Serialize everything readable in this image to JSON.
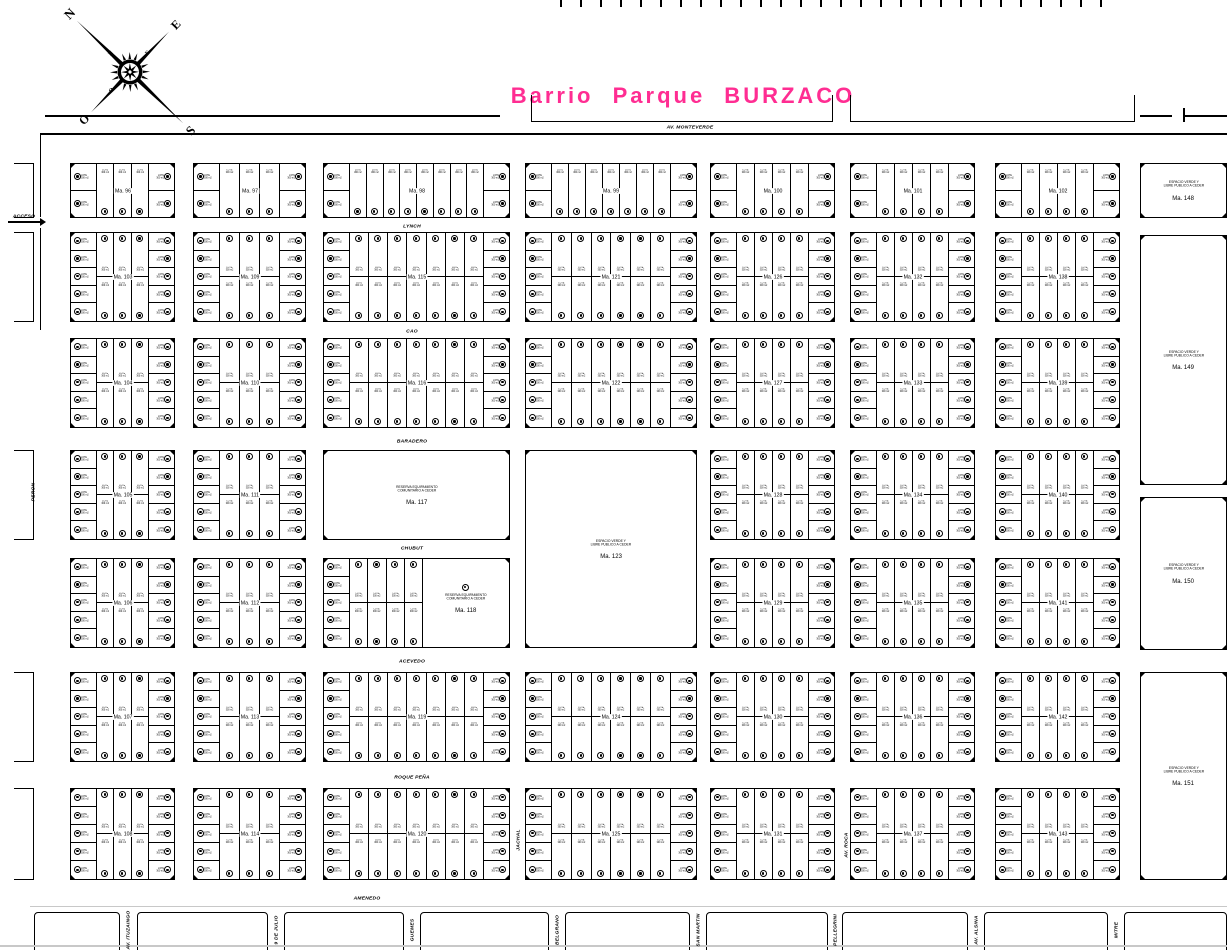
{
  "title": {
    "text": "Barrio Parque BURZACO",
    "color": "#ff2d92"
  },
  "compass": {
    "n": "N",
    "e": "E",
    "s": "S",
    "o": "O"
  },
  "access": {
    "label": "ACCESO"
  },
  "lot": {
    "line1": "LOTE",
    "line2": "300 m2"
  },
  "legend_texts": {
    "reserva": [
      "RESERVA EQUIPAMIENTO",
      "COMUNITARIO  A CEDER"
    ],
    "verde": [
      "ESPACIO VERDE Y",
      "LIBRE PUBLICO A CEDER"
    ]
  },
  "streets": {
    "horizontal": [
      {
        "text": "AV. MONTEVERDE",
        "x": 690,
        "y": 127
      },
      {
        "text": "LYNCH",
        "x": 412,
        "y": 226
      },
      {
        "text": "CAO",
        "x": 412,
        "y": 331
      },
      {
        "text": "BARADERO",
        "x": 412,
        "y": 441
      },
      {
        "text": "CHUBUT",
        "x": 412,
        "y": 548
      },
      {
        "text": "ACEVEDO",
        "x": 412,
        "y": 661
      },
      {
        "text": "ROQUE PEÑA",
        "x": 412,
        "y": 777
      },
      {
        "text": "AMENEDO",
        "x": 367,
        "y": 898
      }
    ],
    "vertical": [
      {
        "text": "PERON",
        "x": 33,
        "y": 492
      },
      {
        "text": "JACHAL",
        "x": 518,
        "y": 840
      },
      {
        "text": "AV. ROCA",
        "x": 846,
        "y": 845
      }
    ],
    "bottom": [
      {
        "text": "AV. ITUZAINGO",
        "x": 128
      },
      {
        "text": "9 DE JULIO",
        "x": 276
      },
      {
        "text": "GUEMES",
        "x": 412
      },
      {
        "text": "BELGRANO",
        "x": 557
      },
      {
        "text": "SAN MARTIN",
        "x": 698
      },
      {
        "text": "PELLEGRINI",
        "x": 835
      },
      {
        "text": "AV. ALSINA",
        "x": 976
      },
      {
        "text": "MITRE",
        "x": 1116
      }
    ]
  },
  "manzanas": {
    "row1": [
      "Ma. 96",
      "Ma. 97",
      "Ma. 98",
      "Ma. 99",
      "Ma. 100",
      "Ma. 101",
      "Ma. 102"
    ],
    "grid": [
      [
        "Ma. 103",
        "Ma. 109",
        "Ma. 115",
        "Ma. 121",
        "Ma. 126",
        "Ma. 132",
        "Ma. 138"
      ],
      [
        "Ma. 104",
        "Ma. 110",
        "Ma. 116",
        "Ma. 122",
        "Ma. 127",
        "Ma. 133",
        "Ma. 139"
      ],
      [
        "Ma. 105",
        "Ma. 111",
        "Ma. 117",
        "Ma. 123",
        "Ma. 128",
        "Ma. 134",
        "Ma. 140"
      ],
      [
        "Ma. 106",
        "Ma. 112",
        "Ma. 118",
        null,
        "Ma. 129",
        "Ma. 135",
        "Ma. 141"
      ],
      [
        "Ma. 107",
        "Ma. 113",
        "Ma. 119",
        "Ma. 124",
        "Ma. 130",
        "Ma. 136",
        "Ma. 142"
      ],
      [
        "Ma. 108",
        "Ma. 114",
        "Ma. 120",
        "Ma. 125",
        "Ma. 131",
        "Ma. 137",
        "Ma. 143"
      ]
    ],
    "east": [
      "Ma. 148",
      "Ma. 149",
      "Ma. 150",
      "Ma. 151"
    ]
  }
}
